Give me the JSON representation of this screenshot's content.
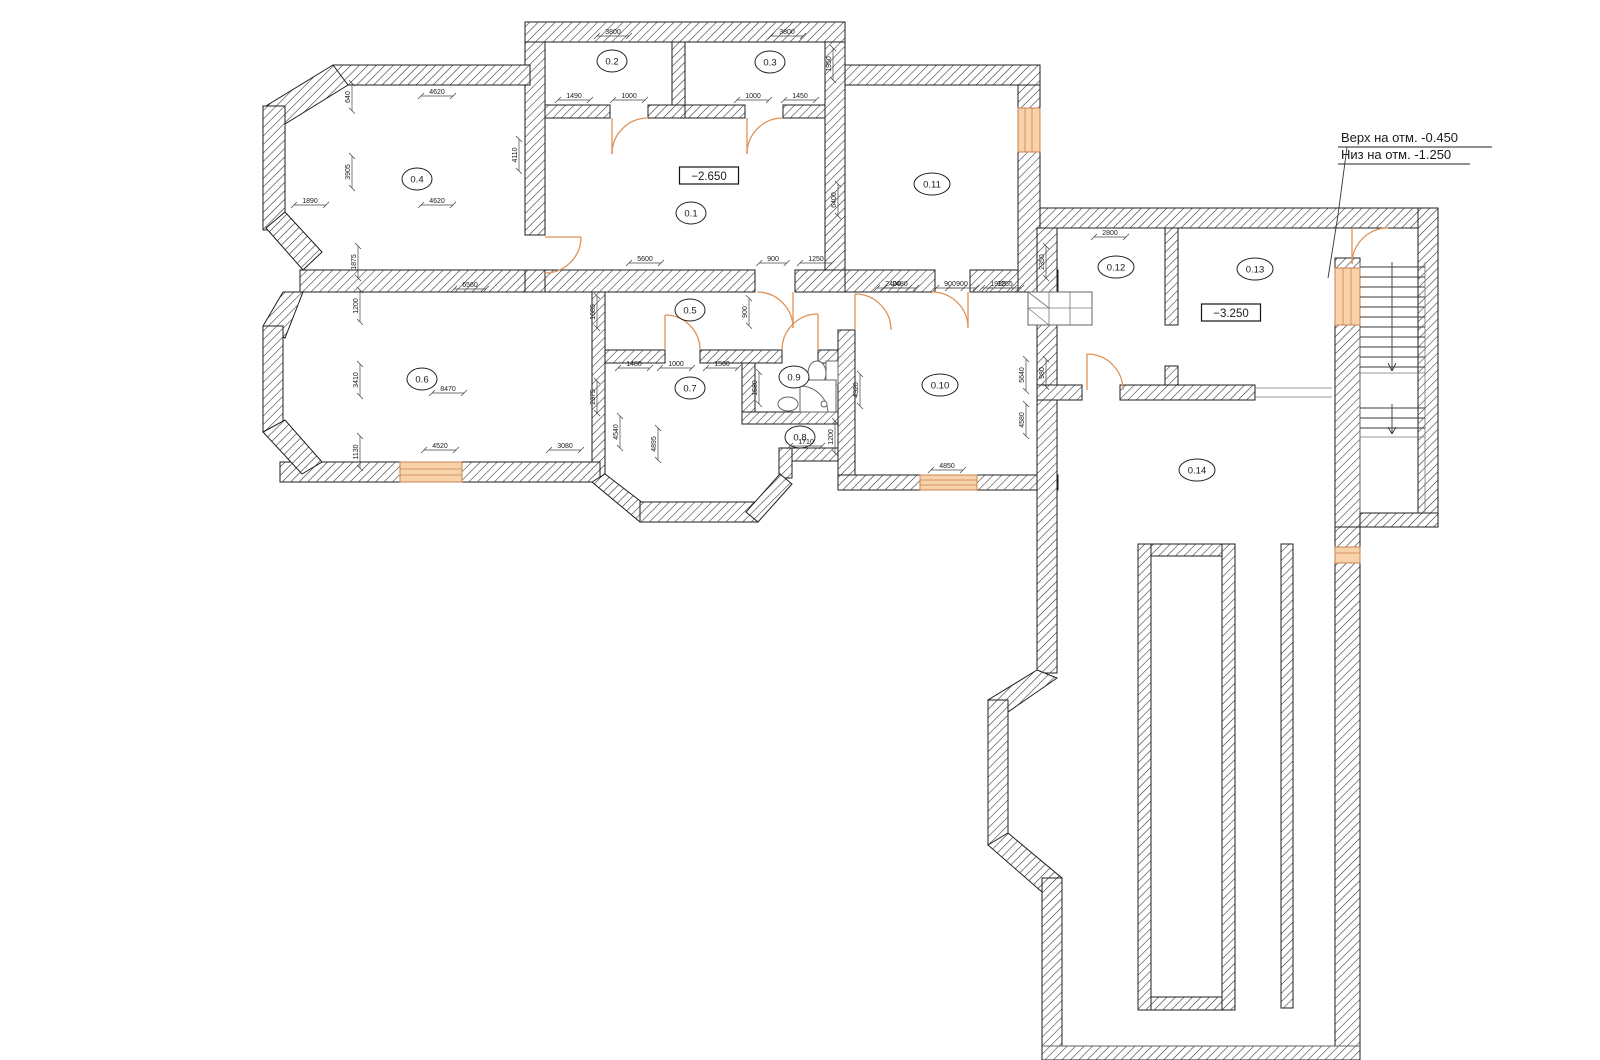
{
  "drawing": {
    "annotation": {
      "line1": "Верх на отм. -0.450",
      "line2": "Низ на отм. -1.250"
    },
    "elevations": [
      {
        "value": "−2.650",
        "x": 709,
        "y": 179
      },
      {
        "value": "−3.250",
        "x": 1231,
        "y": 316
      }
    ],
    "rooms": [
      {
        "label": "0.1",
        "x": 691,
        "y": 213
      },
      {
        "label": "0.2",
        "x": 612,
        "y": 61
      },
      {
        "label": "0.3",
        "x": 770,
        "y": 62
      },
      {
        "label": "0.4",
        "x": 417,
        "y": 179
      },
      {
        "label": "0.5",
        "x": 690,
        "y": 310
      },
      {
        "label": "0.6",
        "x": 422,
        "y": 379
      },
      {
        "label": "0.7",
        "x": 690,
        "y": 388
      },
      {
        "label": "0.8",
        "x": 800,
        "y": 437
      },
      {
        "label": "0.9",
        "x": 794,
        "y": 377
      },
      {
        "label": "0.10",
        "x": 940,
        "y": 385
      },
      {
        "label": "0.11",
        "x": 932,
        "y": 184
      },
      {
        "label": "0.12",
        "x": 1116,
        "y": 267
      },
      {
        "label": "0.13",
        "x": 1255,
        "y": 269
      },
      {
        "label": "0.14",
        "x": 1197,
        "y": 470
      }
    ],
    "dimensions": [
      {
        "v": "3800",
        "x": 613,
        "y": 36,
        "r": 0
      },
      {
        "v": "3800",
        "x": 787,
        "y": 36,
        "r": 0
      },
      {
        "v": "1950",
        "x": 833,
        "y": 64,
        "r": 1
      },
      {
        "v": "1490",
        "x": 574,
        "y": 100,
        "r": 0
      },
      {
        "v": "1000",
        "x": 629,
        "y": 100,
        "r": 0
      },
      {
        "v": "1000",
        "x": 753,
        "y": 100,
        "r": 0
      },
      {
        "v": "1450",
        "x": 800,
        "y": 100,
        "r": 0
      },
      {
        "v": "4620",
        "x": 437,
        "y": 96,
        "r": 0
      },
      {
        "v": "640",
        "x": 352,
        "y": 97,
        "r": 1
      },
      {
        "v": "4110",
        "x": 519,
        "y": 155,
        "r": 1
      },
      {
        "v": "3905",
        "x": 352,
        "y": 172,
        "r": 1
      },
      {
        "v": "4620",
        "x": 437,
        "y": 205,
        "r": 0
      },
      {
        "v": "1890",
        "x": 310,
        "y": 205,
        "r": 0
      },
      {
        "v": "1875",
        "x": 358,
        "y": 262,
        "r": 1
      },
      {
        "v": "5600",
        "x": 645,
        "y": 263,
        "r": 0
      },
      {
        "v": "900",
        "x": 773,
        "y": 263,
        "r": 0
      },
      {
        "v": "1250",
        "x": 816,
        "y": 263,
        "r": 0
      },
      {
        "v": "6400",
        "x": 838,
        "y": 200,
        "r": 1
      },
      {
        "v": "900",
        "x": 749,
        "y": 312,
        "r": 1
      },
      {
        "v": "2400",
        "x": 893,
        "y": 288,
        "r": 0
      },
      {
        "v": "900",
        "x": 950,
        "y": 288,
        "r": 0
      },
      {
        "v": "1935",
        "x": 998,
        "y": 288,
        "r": 0
      },
      {
        "v": "6560",
        "x": 470,
        "y": 289,
        "r": 0
      },
      {
        "v": "1200",
        "x": 360,
        "y": 306,
        "r": 1
      },
      {
        "v": "3410",
        "x": 360,
        "y": 380,
        "r": 1
      },
      {
        "v": "1130",
        "x": 360,
        "y": 452,
        "r": 1
      },
      {
        "v": "8470",
        "x": 448,
        "y": 393,
        "r": 0
      },
      {
        "v": "4520",
        "x": 440,
        "y": 450,
        "r": 0
      },
      {
        "v": "3080",
        "x": 565,
        "y": 450,
        "r": 0
      },
      {
        "v": "1685",
        "x": 597,
        "y": 312,
        "r": 1
      },
      {
        "v": "2375",
        "x": 597,
        "y": 397,
        "r": 1
      },
      {
        "v": "1480",
        "x": 634,
        "y": 368,
        "r": 0
      },
      {
        "v": "1000",
        "x": 676,
        "y": 368,
        "r": 0
      },
      {
        "v": "1560",
        "x": 722,
        "y": 368,
        "r": 0
      },
      {
        "v": "4540",
        "x": 620,
        "y": 432,
        "r": 1
      },
      {
        "v": "4895",
        "x": 658,
        "y": 444,
        "r": 1
      },
      {
        "v": "1580",
        "x": 759,
        "y": 388,
        "r": 1
      },
      {
        "v": "1710",
        "x": 806,
        "y": 446,
        "r": 0
      },
      {
        "v": "1200",
        "x": 835,
        "y": 437,
        "r": 1
      },
      {
        "v": "2480",
        "x": 900,
        "y": 288,
        "r": 0
      },
      {
        "v": "900",
        "x": 962,
        "y": 288,
        "r": 0
      },
      {
        "v": "1255",
        "x": 1005,
        "y": 288,
        "r": 0
      },
      {
        "v": "5640",
        "x": 1026,
        "y": 375,
        "r": 1
      },
      {
        "v": "4580",
        "x": 1026,
        "y": 420,
        "r": 1
      },
      {
        "v": "4320",
        "x": 860,
        "y": 390,
        "r": 1
      },
      {
        "v": "4850",
        "x": 947,
        "y": 470,
        "r": 0
      },
      {
        "v": "2800",
        "x": 1110,
        "y": 237,
        "r": 0
      },
      {
        "v": "2350",
        "x": 1046,
        "y": 262,
        "r": 1
      },
      {
        "v": "980",
        "x": 1046,
        "y": 373,
        "r": 1
      }
    ],
    "colors": {
      "line": "#1f1f1f",
      "hatch": "#2b2b2b",
      "window_fill": "#f8d2ab",
      "window_stroke": "#c9824e",
      "door": "#de9257",
      "dim_text": "#1a1a1a"
    }
  }
}
